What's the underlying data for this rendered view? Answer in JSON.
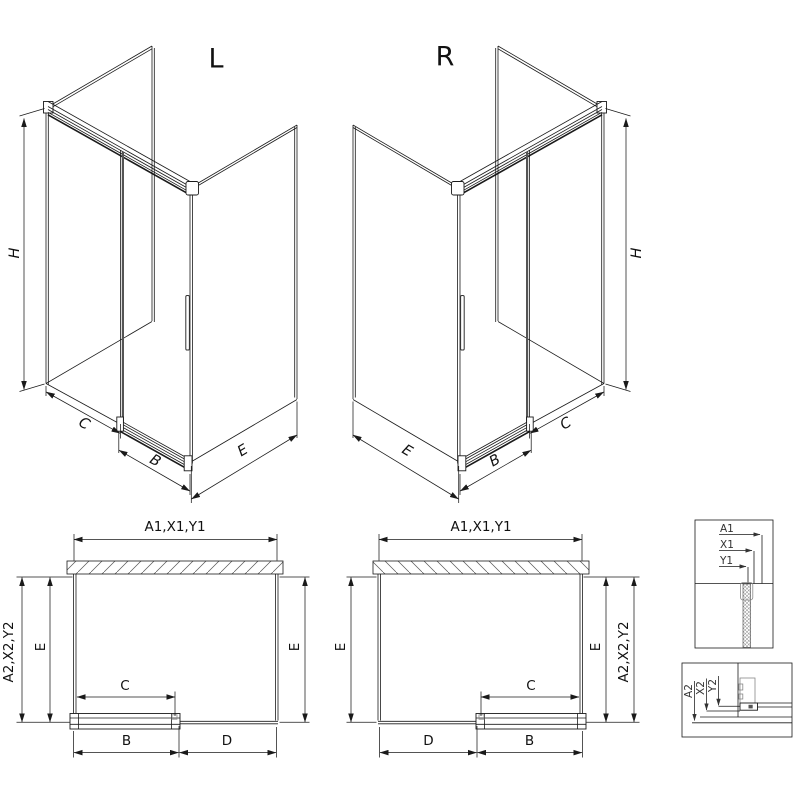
{
  "drawing_title": "Shower enclosure dimension diagram",
  "iso_left": {
    "title": "L",
    "h": "H",
    "c": "C",
    "b": "B",
    "e": "E"
  },
  "iso_right": {
    "title": "R",
    "h": "H",
    "c": "C",
    "b": "B",
    "e": "E"
  },
  "plan_left": {
    "top": "A1,X1,Y1",
    "side_outer": "A2,X2,Y2",
    "depth_left": "E",
    "depth_right": "E",
    "opening": "C",
    "door": "B",
    "fixed": "D"
  },
  "plan_right": {
    "top": "A1,X1,Y1",
    "side_outer": "A2,X2,Y2",
    "depth_left": "E",
    "depth_right": "E",
    "opening": "C",
    "door": "B",
    "fixed": "D"
  },
  "detail_wall": {
    "labels": [
      "A1",
      "X1",
      "Y1"
    ]
  },
  "detail_floor": {
    "labels": [
      "A2",
      "X2",
      "Y2"
    ]
  },
  "colors": {
    "line": "#1a1a1a",
    "profile_gray": "#888",
    "background": "#ffffff"
  }
}
